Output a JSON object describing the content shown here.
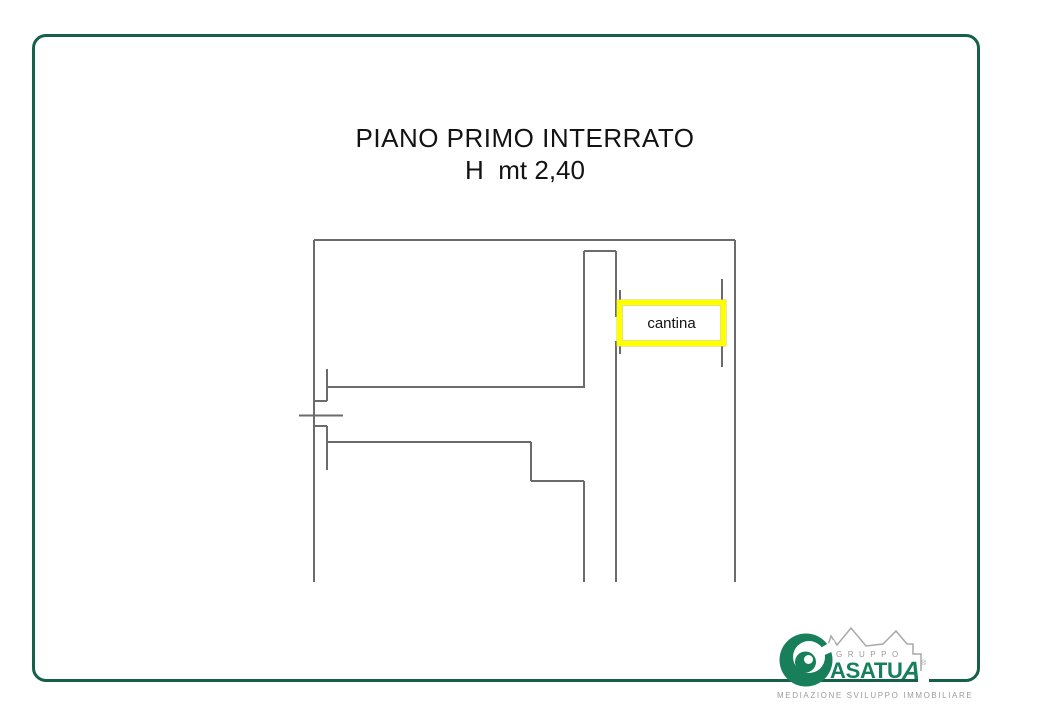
{
  "title": {
    "line1": "PIANO PRIMO INTERRATO",
    "line2": "H  mt 2,40"
  },
  "plan": {
    "room_label": "cantina"
  },
  "logo": {
    "group_label": "GRUPPO",
    "brand_text": "ASATU",
    "brand_text_accent": "A",
    "registered_mark": "®",
    "tagline": "MEDIAZIONE SVILUPPO IMMOBILIARE"
  },
  "colors": {
    "frame_green": "#166049",
    "logo_green": "#17805a",
    "plan_line_gray": "#6b6b6b",
    "highlight_yellow": "#ffff00",
    "logo_text_gray": "#9b9b9b"
  }
}
